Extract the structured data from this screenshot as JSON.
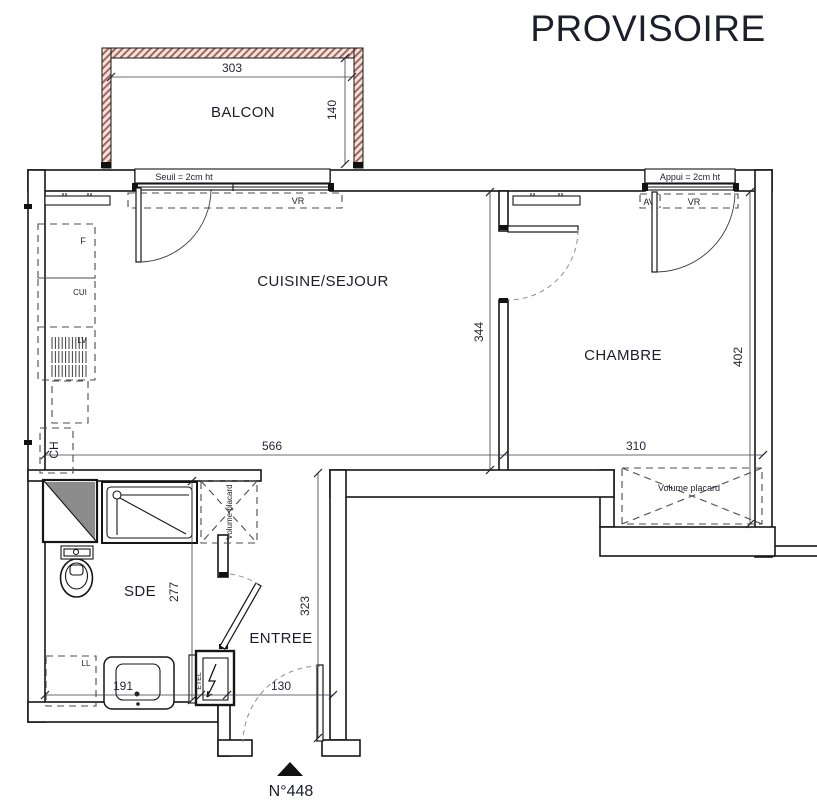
{
  "title": "PROVISOIRE",
  "rooms": {
    "balcon": "BALCON",
    "cuisine_sejour": "CUISINE/SEJOUR",
    "chambre": "CHAMBRE",
    "sde": "SDE",
    "entree": "ENTREE"
  },
  "openings": {
    "seuil": "Seuil = 2cm ht",
    "appui": "Appui = 2cm ht",
    "vr": "VR",
    "av": "AV"
  },
  "equipment": {
    "fridge": "F",
    "cooker": "CUI",
    "dishwasher": "LV",
    "water_heater": "CH",
    "washing_machine": "LL",
    "electrical_panel": "ETEL",
    "placard_sde": "Volume placard",
    "placard_chambre": "Volume placard"
  },
  "dimensions": {
    "balcon_width": "303",
    "balcon_depth": "140",
    "sejour_width": "566",
    "sejour_depth": "344",
    "chambre_width": "310",
    "chambre_depth": "402",
    "sde_depth": "277",
    "sde_width": "191",
    "entree_depth": "323",
    "entree_width": "130"
  },
  "marker": {
    "unit_number": "N°448"
  },
  "colors": {
    "hatch": "#a2675c",
    "hatch_bg": "#f2e3dd",
    "fixture_gray": "#8c8c8c"
  }
}
